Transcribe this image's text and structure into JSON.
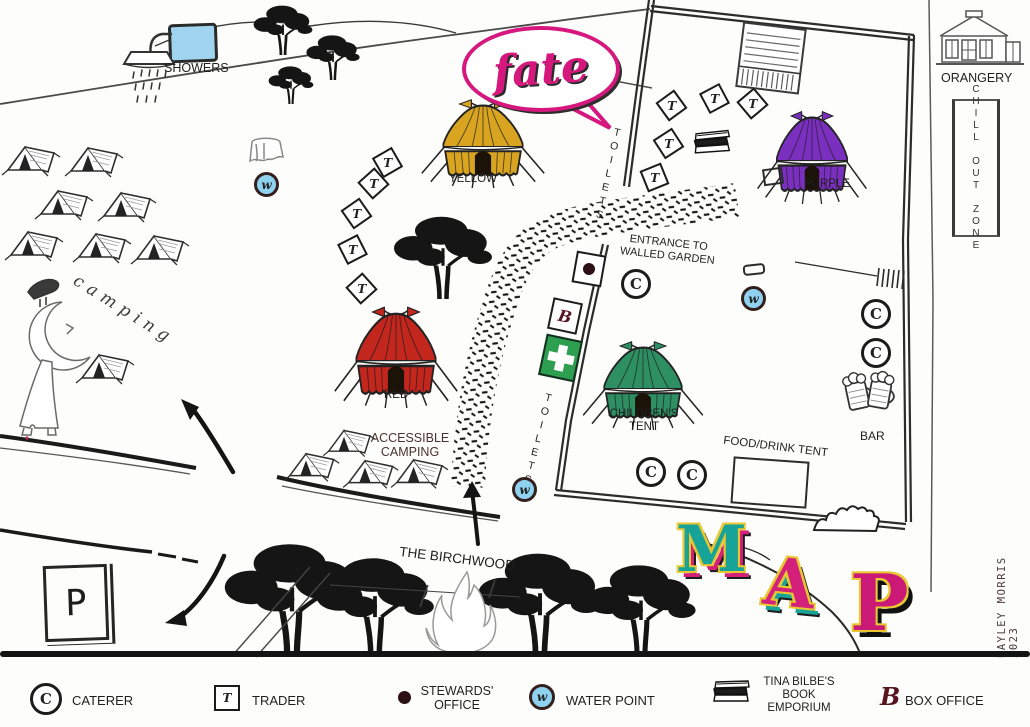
{
  "logo": {
    "text": "fate"
  },
  "labels": {
    "showers": "SHOWERS",
    "yellow_tent": "YELLOW",
    "red_tent": "RED",
    "purple_tent": "PURPLE",
    "childrens_tent": "CHILDREN'S TENT",
    "camping": "camping",
    "accessible_camping": "ACCESSIBLE CAMPING",
    "toilets_upper": "TOILETS",
    "toilets_lower": "TOILETS",
    "entrance_walled_garden": "ENTRANCE TO WALLED GARDEN",
    "food_drink_tent": "FOOD/DRINK TENT",
    "bar": "BAR",
    "orangery": "ORANGERY",
    "chill_out_zone": "CHILL OUT ZONE",
    "birchwood": "THE BIRCHWOOD",
    "credit": "BAYLEY MORRIS 2023"
  },
  "map_title": {
    "m": "M",
    "a": "A",
    "p": "P"
  },
  "glyphs": {
    "caterer": "C",
    "trader": "T",
    "water": "w",
    "box_office": "B",
    "parking": "P"
  },
  "legend": {
    "caterer": "CATERER",
    "trader": "TRADER",
    "stewards": "STEWARDS' OFFICE",
    "water": "WATER POINT",
    "book": "TINA BILBE'S BOOK EMPORIUM",
    "box_office": "BOX OFFICE"
  },
  "colors": {
    "accent_pink": "#d6187e",
    "water_blue": "#8fd2f0",
    "first_aid_green": "#2e9e50",
    "yellow_tent": "#d9a520",
    "red_tent": "#c3261c",
    "purple_tent": "#7a2fbf",
    "green_tent": "#2e8f62"
  }
}
